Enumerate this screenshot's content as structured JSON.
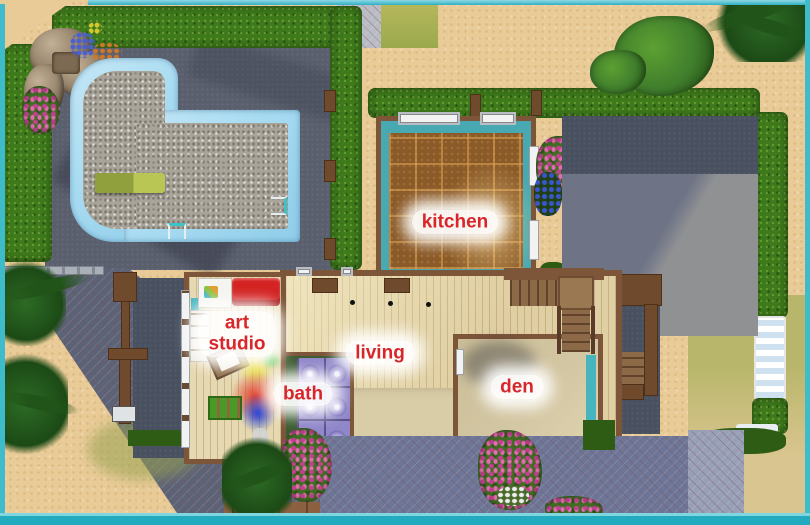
{
  "rooms": {
    "kitchen": {
      "label": "kitchen"
    },
    "art_studio": {
      "line1": "art",
      "line2": "studio"
    },
    "living": {
      "label": "living"
    },
    "bath": {
      "label": "bath"
    },
    "den": {
      "label": "den"
    }
  },
  "scene": {
    "view": "top-down lot floor plan",
    "objects": [
      "swimming-pool",
      "rock-waterfall",
      "diving-board",
      "pool-ladder",
      "hedge",
      "palm-tree",
      "flower-bush",
      "lounge-chair",
      "mailbox",
      "driveway",
      "staircase",
      "sofa",
      "easel",
      "bookshelf",
      "art-cabinet",
      "storage-crate",
      "porch-light",
      "lot-border"
    ]
  },
  "colors": {
    "lot_border": "#3fbccb",
    "sand": "#e9cb97",
    "hedge": "#3e7a1b",
    "grass_dark": "#2f5c14",
    "grass_yellow": "#b5b45c",
    "slate": "#5a5f6e",
    "slate_dark": "#495160",
    "pool_water": "#a9dcf2",
    "gravel": "#a9a49a",
    "diving_board": "#9aa943",
    "kitchen_wall_teal": "#49a9b2",
    "kitchen_floor": "#8a5a28",
    "wall_brown": "#7d5539",
    "wood_floor": "#e0cfa3",
    "rug": "#d9cda8",
    "den_carpet": "#d3c6a2",
    "bath_tile": "#8f87c9",
    "bath_grout": "#5a5088",
    "bath_wall_green": "#3c5c31",
    "sofa_red": "#d32322",
    "stair_wood": "#8d6a47",
    "teal_accent": "#46b5c0",
    "paving_light": "#8f9193",
    "paving_shadow": "#6e7386",
    "drive_blue": "#6d7697",
    "drive_dark": "#5c6377",
    "flower_pink": "#c2408f",
    "palm_green": "#1f4e1b",
    "label_red": "#d9262b",
    "window_white": "#f2f2f2"
  }
}
